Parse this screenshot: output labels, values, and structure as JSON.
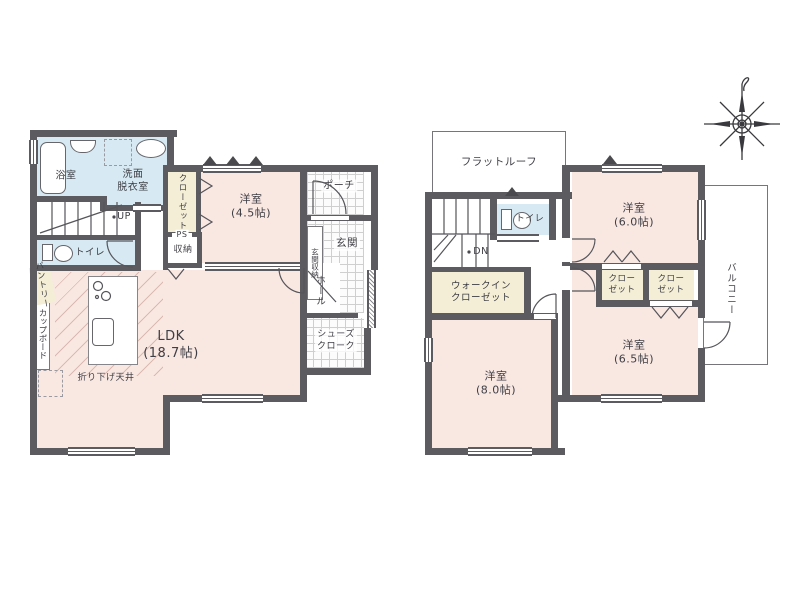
{
  "colors": {
    "wall": "#5c5c60",
    "room_pink": "#f9e7e2",
    "wet_area_blue": "#d7e9f3",
    "closet_cream": "#f4eed6",
    "linework": "#55555a"
  },
  "floor1": {
    "bath": "浴室",
    "washroom": "洗面\n脱衣室",
    "closet": "クローゼット",
    "stairs_up": "UP",
    "toilet": "トイレ",
    "ps": "PS",
    "storage": "収納",
    "bedroom45": "洋室\n(4.5帖)",
    "porch": "ポーチ",
    "entrance": "玄関",
    "entrance_storage": "玄関収納",
    "hall": "ホール",
    "shoes_cloak": "シューズ\nクローク",
    "ldk": "LDK\n(18.7帖)",
    "lowered_ceiling": "折り下げ天井",
    "pantry": "パントリー",
    "cupboard": "カップボード"
  },
  "floor2": {
    "flat_roof": "フラットルーフ",
    "stairs_down": "DN",
    "toilet": "トイレ",
    "bedroom60": "洋室\n(6.0帖)",
    "closet_a": "クロー\nゼット",
    "closet_b": "クロー\nゼット",
    "balcony": "バルコニー",
    "walk_in_closet": "ウォークイン\nクローゼット",
    "bedroom80": "洋室\n(8.0帖)",
    "bedroom65": "洋室\n(6.5帖)"
  }
}
